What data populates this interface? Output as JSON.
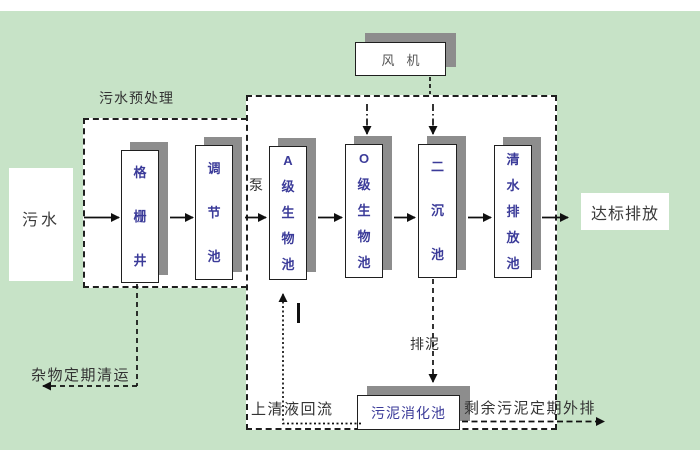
{
  "diagram": {
    "type": "wastewater-treatment-process-flow",
    "background_color": "#c7e3c7",
    "shadow_color": "#8d8d8d",
    "tank_text_color": "#3b3b99",
    "label_text_color": "#333333"
  },
  "nodes": {
    "sewage": "污水",
    "grid_well": "格栅井",
    "regulating_tank": "调节池",
    "a_bio_tank": "A级生物池",
    "o_bio_tank": "O级生物池",
    "secondary_sedimentation_tank": "二沉池",
    "clear_water_discharge_tank": "清水排放池",
    "standard_discharge": "达标排放",
    "fan": "风机",
    "sludge_digestion_tank": "污泥消化池"
  },
  "labels": {
    "pretreatment": "污水预处理",
    "pump": "泵",
    "debris_removal": "杂物定期清运",
    "supernatant_return": "上清液回流",
    "sludge_discharge": "排泥",
    "excess_sludge_out": "剩余污泥定期外排"
  }
}
